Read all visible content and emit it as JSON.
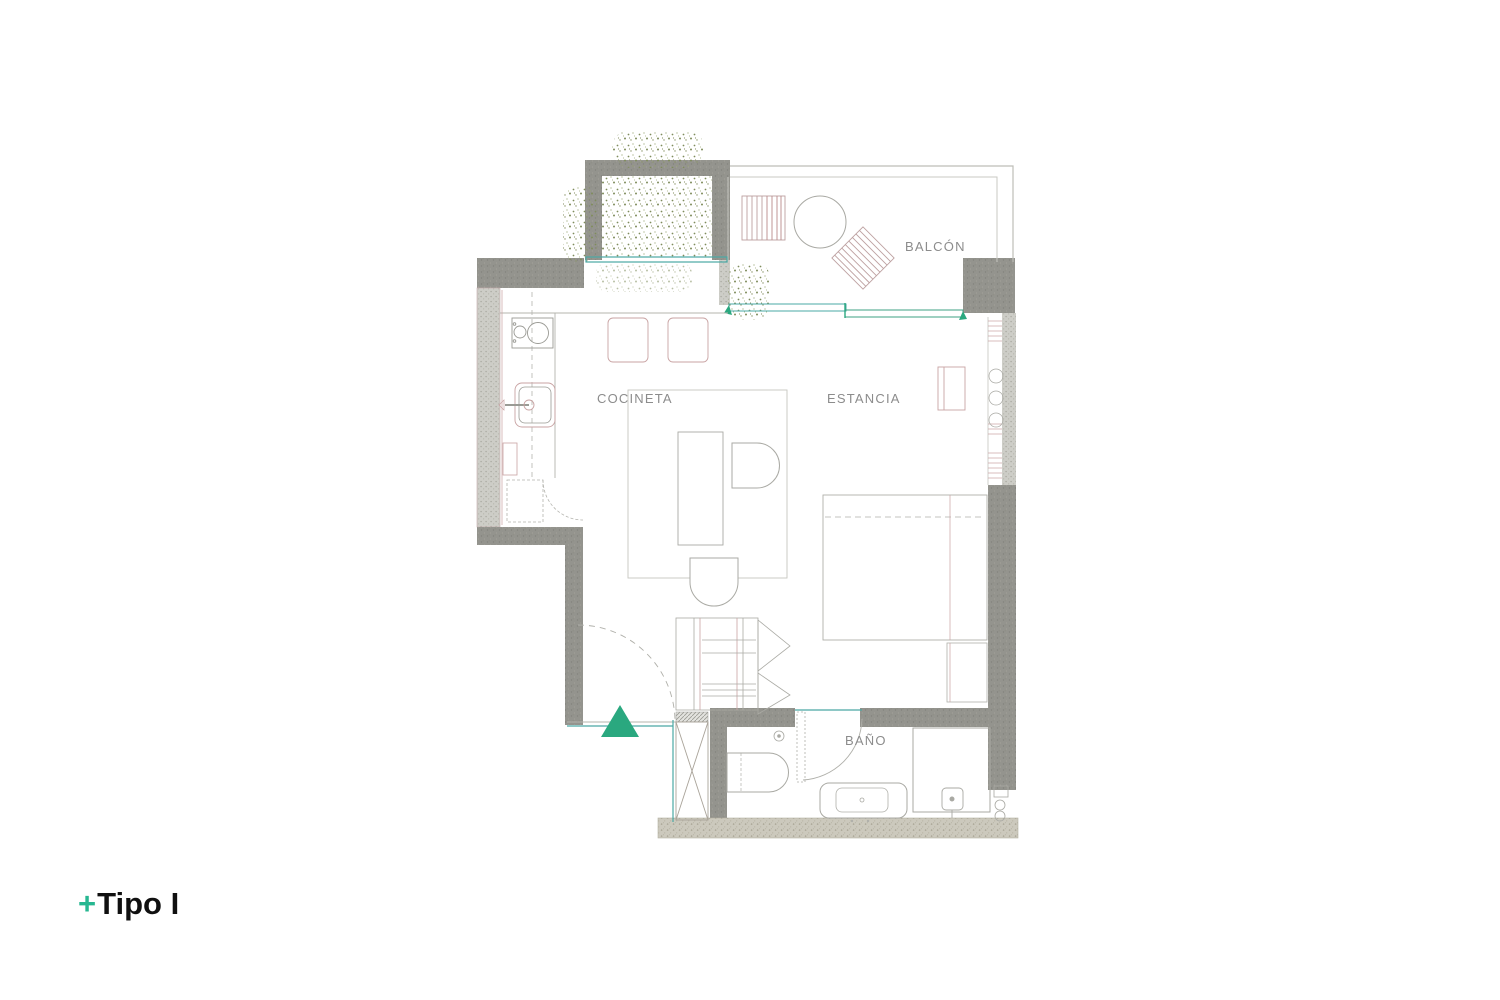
{
  "plan": {
    "rooms": {
      "balcon": "BALCÓN",
      "cocineta": "COCINETA",
      "estancia": "ESTANCIA",
      "bano": "BAÑO"
    },
    "colors": {
      "wall_solid": "#91918b",
      "wall_light": "#cdcdc7",
      "wall_sand": "#ccc9bd",
      "furniture_pink": "#c49c9c",
      "furniture_gray": "#a9a9a3",
      "window_teal": "#4aa8a4",
      "accent_green": "#2aa87f",
      "vegetation_olive": "#8a9468",
      "label_gray": "#8c8c8c",
      "title_black": "#101010",
      "title_plus_green": "#27b791"
    }
  },
  "footer": {
    "plus": "+",
    "title": "Tipo I"
  }
}
